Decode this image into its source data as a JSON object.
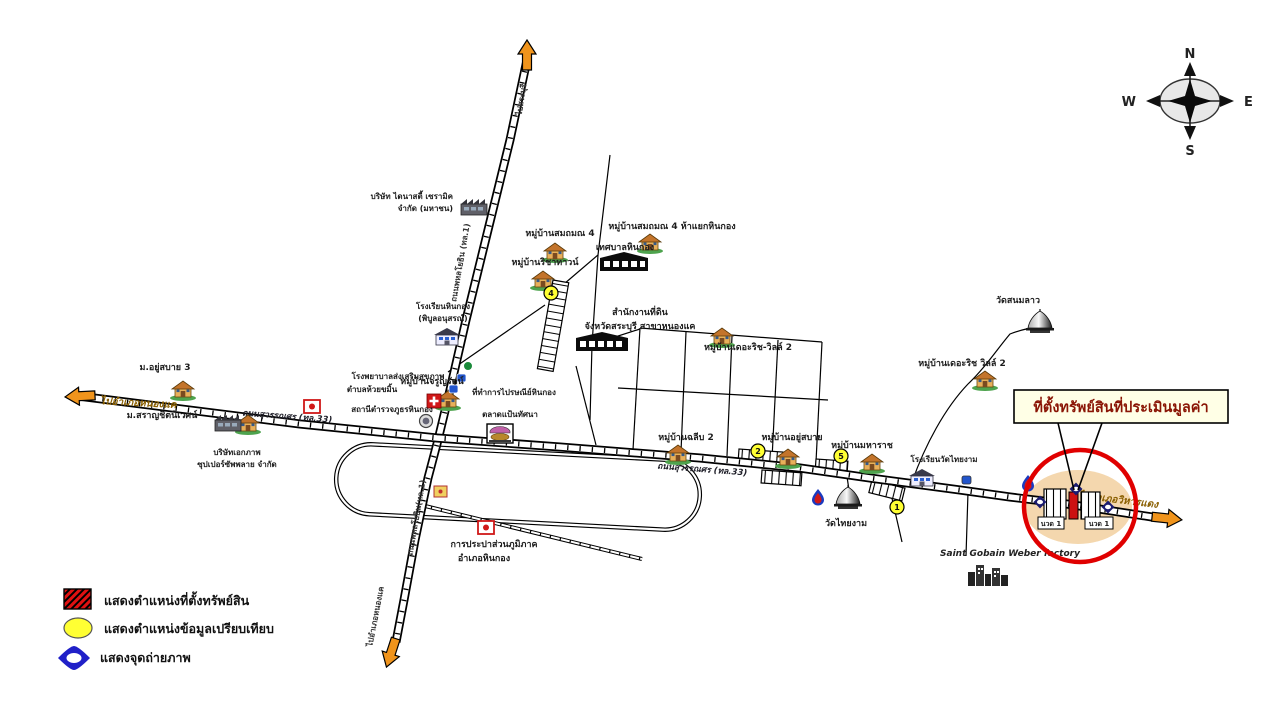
{
  "compass": {
    "n": "N",
    "e": "E",
    "w": "W",
    "s": "S"
  },
  "directions": {
    "west": "ไปอำเภอหนองแค",
    "east": "ไปอำเภอวิหารแดง",
    "north": "ไปสระบุรี",
    "south": "ไปอำเภอหนองแค"
  },
  "roads": {
    "suwannasorn_w": "ถนนสุวรรณศร (ทล.33)",
    "suwannasorn_e": "ถนนสุวรรณศร (ทล.33)",
    "phahonyothin_n": "ถนนพหลโยธิน (ทล.1)",
    "phahonyothin_s": "ถนนพหลโยธิน(ทล.1)"
  },
  "places": {
    "dynasty_line1": "บริษัท ไดนาสตี้ เซรามิค",
    "dynasty_line2": "จำกัด (มหาชน)",
    "village_sommon4": "หมู่บ้านสมถมณ 4",
    "village_sommon4b": "หมู่บ้านสมถมณ 4 ห้าแยกหินกอง",
    "village_richatown": "หมู่บ้านริชาทาวน์",
    "hinkong_municipality": "เทศบาลหินกอง",
    "land_office_line1": "สำนักงานที่ดิน",
    "land_office_line2": "จังหวัดสระบุรี สาขาหนองแค",
    "hinkong_school_line1": "โรงเรียนหินกอง",
    "hinkong_school_line2": "(พิบูลอนุสรณ์)",
    "village_therich2": "หมู่บ้านเดอะริช-วิลล์ 2",
    "wat_sanomlao": "วัดสนมลาว",
    "village_therich2b": "หมู่บ้านเดอะริช วิลล์ 2",
    "village_yusabai3": "ม.อยู่สบาย 3",
    "village_charoonrat": "หมู่บ้านจรูญรัตน์",
    "health_center_line1": "โรงพยาบาลส่งเสริมสุขภาพ",
    "health_center_line2": "ตำบลห้วยขมิ้น",
    "post_office": "ที่ทำการไปรษณีย์หินกอง",
    "police_station": "สถานีตำรวจภูธรหินกอง",
    "village_saranchit": "ม.สราญชิตนิเวศน์",
    "ekkaphap_line1": "บริษัทเอกภาพ",
    "ekkaphap_line2": "ซุปเปอร์ซัพพลาย จำกัด",
    "market": "ตลาดแป้นทัศนา",
    "village_chalip2": "หมู่บ้านฉลีบ 2",
    "village_yusabai": "หมู่บ้านอยู่สบาย",
    "village_maharat": "หมู่บ้านมหาราช",
    "wat_thaingam": "วัดไทยงาม",
    "thaingam_school": "โรงเรียนวัดไทยงาม",
    "saint_gobain": "Saint Gobain Weber factory",
    "waterworks_line1": "การประปาส่วนภูมิภาค",
    "waterworks_line2": "อำเภอหินกอง"
  },
  "property": {
    "callout": "ที่ตั้งทรัพย์สินที่ประเมินมูลค่า",
    "plot_left": "นวด 1",
    "plot_right": "นวด 1"
  },
  "comparison_points": {
    "p1": "1",
    "p2": "2",
    "p4": "4",
    "p5": "5"
  },
  "legend": {
    "property_label": "แสดงตำแหน่งที่ตั้งทรัพย์สิน",
    "comparison_label": "แสดงตำแหน่งข้อมูลเปรียบเทียบ",
    "photo_label": "แสดงจุดถ่ายภาพ"
  },
  "colors": {
    "accent_red": "#dd0000",
    "comparison_yellow": "#ffff33",
    "photo_blue": "#1b1bc0",
    "arrow_orange": "#f0941c",
    "callout_bg": "#ffffe6",
    "site_ellipse": "#f4d7ae"
  }
}
